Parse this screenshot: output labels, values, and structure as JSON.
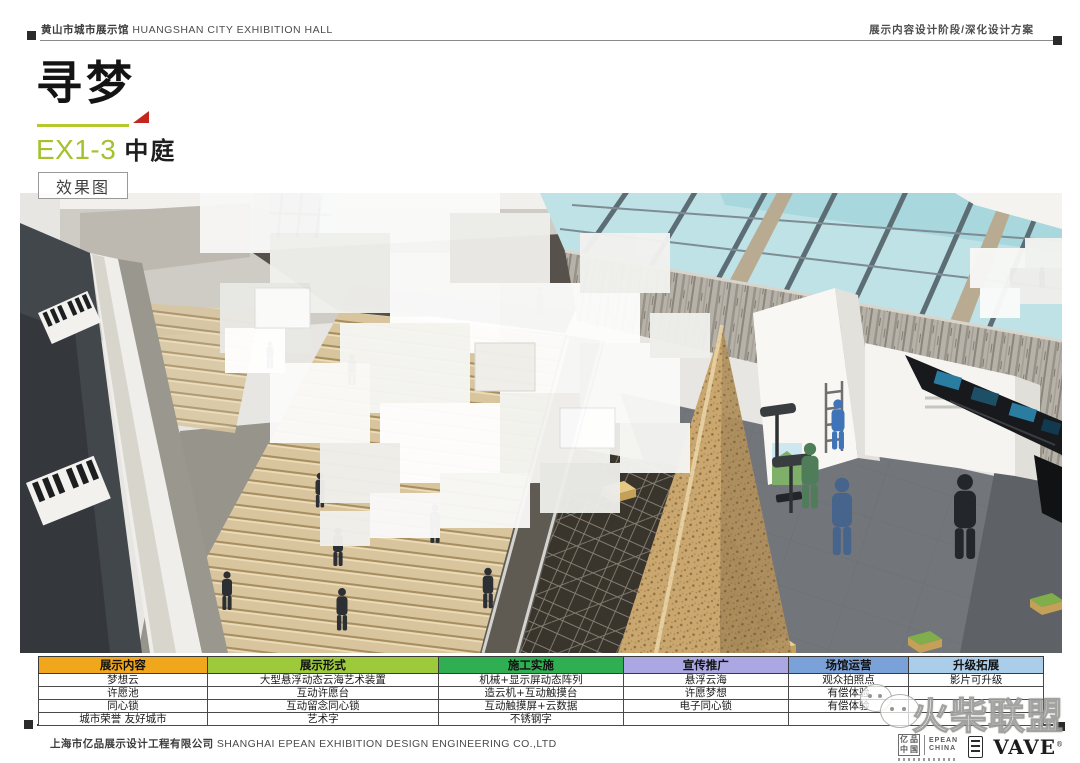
{
  "header": {
    "left_zh": "黄山市城市展示馆",
    "left_en": "HUANGSHAN  CITY  EXHIBITION  HALL",
    "right": "展示内容设计阶段/深化设计方案"
  },
  "title": {
    "main": "寻梦",
    "code": "EX1-3",
    "area": "中庭",
    "tag": "效果图",
    "accent_green": "#a4c22d",
    "accent_red": "#c4251c"
  },
  "table": {
    "columns": [
      {
        "label": "展示内容",
        "color": "#f0a71c",
        "rows": [
          "梦想云",
          "许愿池",
          "同心锁",
          "城市荣誉  友好城市"
        ]
      },
      {
        "label": "展示形式",
        "color": "#9dca3b",
        "rows": [
          "大型悬浮动态云海艺术装置",
          "互动许愿台",
          "互动留念同心锁",
          "艺术字"
        ]
      },
      {
        "label": "施工实施",
        "color": "#2fae52",
        "rows": [
          "机械+显示屏动态阵列",
          "造云机+互动触摸台",
          "互动触摸屏+云数据",
          "不锈钢字"
        ]
      },
      {
        "label": "宣传推广",
        "color": "#aaa7e2",
        "rows": [
          "悬浮云海",
          "许愿梦想",
          "电子同心锁",
          ""
        ]
      },
      {
        "label": "场馆运营",
        "color": "#7aa1d8",
        "rows": [
          "观众拍照点",
          "有偿体验",
          "有偿体验",
          ""
        ]
      },
      {
        "label": "升级拓展",
        "color": "#aacdea",
        "rows": [
          "影片可升级",
          "",
          "",
          ""
        ]
      }
    ]
  },
  "watermark": {
    "text": "火柴联盟"
  },
  "footer": {
    "company_zh": "上海市亿品展示设计工程有限公司",
    "company_en": "SHANGHAI  EPEAN  EXHIBITION  DESIGN  ENGINEERING  CO.,LTD",
    "logos": {
      "epean_chars": [
        "亿",
        "品",
        "中",
        "国"
      ],
      "epean_en_1": "EPEAN",
      "epean_en_2": "CHINA",
      "vave": "VAVE",
      "reg": "®"
    }
  }
}
